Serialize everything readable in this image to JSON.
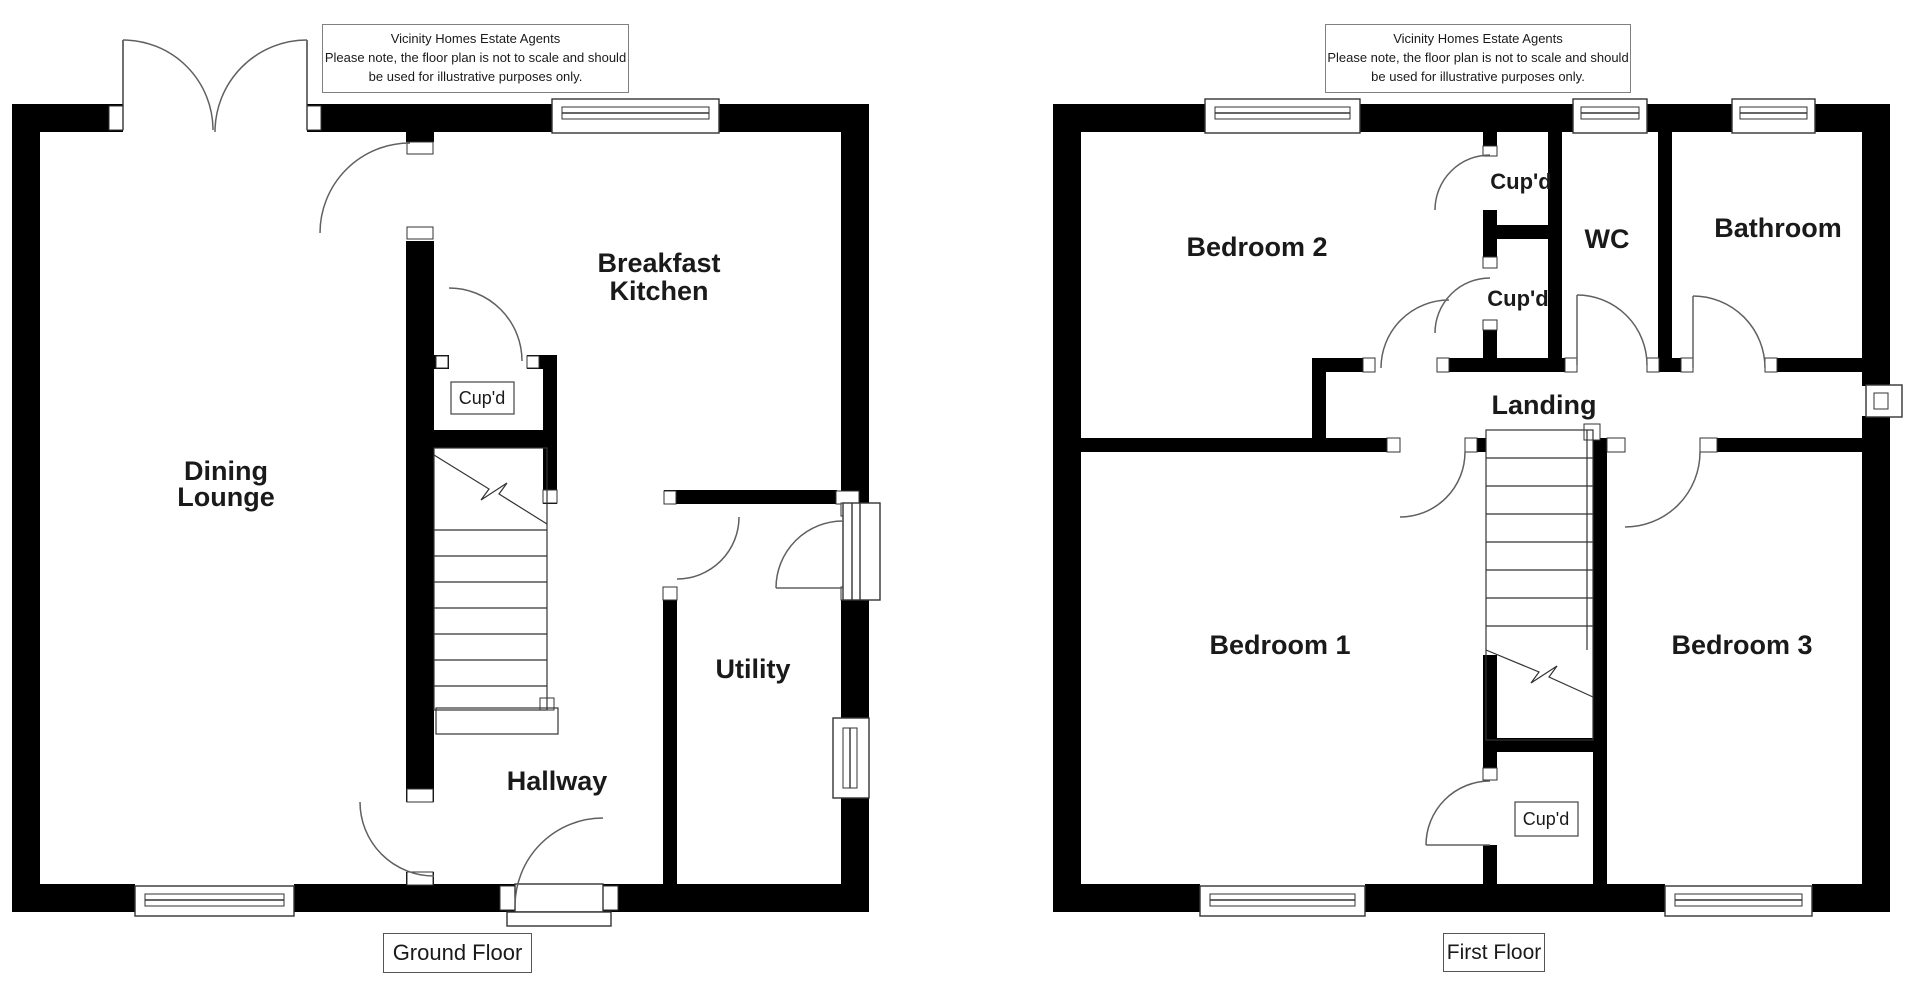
{
  "disclaimer": {
    "line1": "Vicinity Homes Estate Agents",
    "line2": "Please note, the floor plan is not to scale and should",
    "line3": "be used for illustrative purposes only."
  },
  "ground_floor": {
    "title": "Ground Floor",
    "dining_line1": "Dining",
    "dining_line2": "Lounge",
    "kitchen_line1": "Breakfast",
    "kitchen_line2": "Kitchen",
    "cupboard": "Cup'd",
    "hallway": "Hallway",
    "utility": "Utility"
  },
  "first_floor": {
    "title": "First Floor",
    "bedroom1": "Bedroom 1",
    "bedroom2": "Bedroom 2",
    "bedroom3": "Bedroom 3",
    "bathroom": "Bathroom",
    "wc": "WC",
    "landing": "Landing",
    "cupboard_upper": "Cup'd",
    "cupboard_lower": "Cup'd",
    "cupboard_bedroom": "Cup'd"
  },
  "colors": {
    "wall": "#000000",
    "arc": "#606060",
    "text": "#1a1a1a"
  }
}
